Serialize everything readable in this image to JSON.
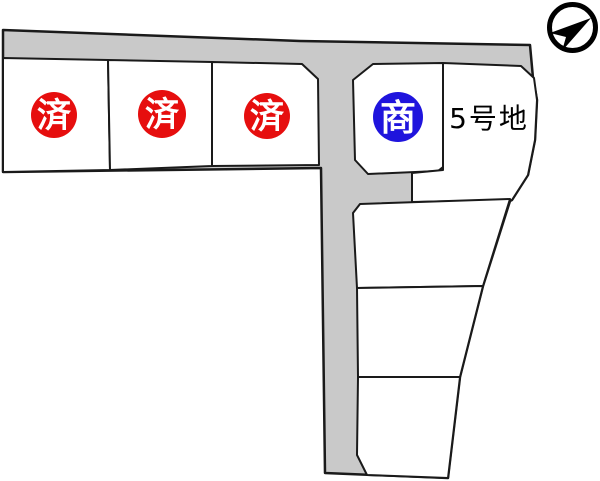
{
  "map": {
    "type": "land-subdivision-plot-map",
    "compass": {
      "icon": "north-arrow"
    },
    "colors": {
      "road": "#c9c9c9",
      "lot": "#ffffff",
      "lot_highlight": "#fbf7c2",
      "badge_sold": "#e60e0e",
      "badge_negotiation": "#1f14dd",
      "outline": "#1a1a1a",
      "badge_text": "#ffffff",
      "label_text": "#000000"
    },
    "lots": [
      {
        "name": "lot-1",
        "badge": "済",
        "status": "sold"
      },
      {
        "name": "lot-2",
        "badge": "済",
        "status": "sold"
      },
      {
        "name": "lot-3",
        "badge": "済",
        "status": "sold"
      },
      {
        "name": "lot-4",
        "badge": "商",
        "status": "under-negotiation"
      },
      {
        "name": "lot-5",
        "label": "5号地",
        "status": "available"
      },
      {
        "name": "lot-6",
        "status": "unlabeled"
      },
      {
        "name": "lot-7",
        "status": "unlabeled"
      },
      {
        "name": "lot-8",
        "status": "unlabeled"
      }
    ]
  }
}
